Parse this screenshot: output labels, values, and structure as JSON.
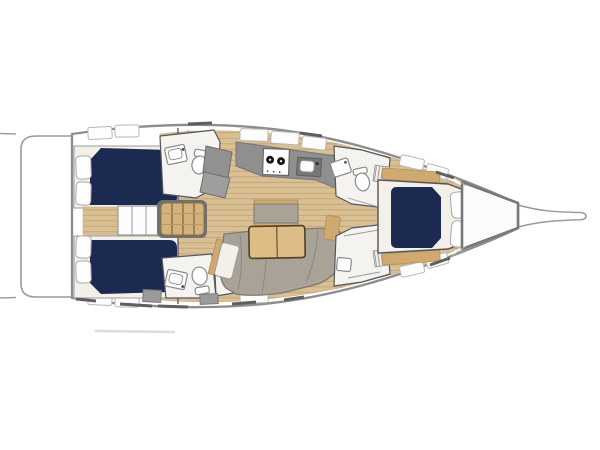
{
  "meta": {
    "type": "yacht-interior-floor-plan",
    "orientation": "bow-right",
    "background": "#ffffff"
  },
  "colors": {
    "hull_stroke": "#8e8e8e",
    "wall_stroke": "#55555e",
    "bed_navy": "#1c2950",
    "wood_floor": "#d9c094",
    "plank_line": "#c3a273",
    "wood_trim": "#cfa96f",
    "steps_wood": "#d4b27b",
    "table_wood": "#debc85",
    "table_edge": "#4f3e29",
    "sofa_gray": "#a9a296",
    "sofa_edge": "#7e7870",
    "counter_gray": "#8f8f8f",
    "shower_gray": "#919191",
    "room_floor": "#f5f3ef",
    "berth_cream": "#f2f0e9",
    "pillow_white": "#fdfdfd",
    "burner_black": "#1a1a1a"
  },
  "areas": [
    {
      "id": "swim-platform",
      "label": "Stern swim platform"
    },
    {
      "id": "aft-cabin-port",
      "label": "Aft double cabin (port)"
    },
    {
      "id": "aft-cabin-starboard",
      "label": "Aft double cabin (starboard)"
    },
    {
      "id": "companionway",
      "label": "Companionway steps"
    },
    {
      "id": "head-aft-port",
      "label": "Aft head with shower (port)"
    },
    {
      "id": "head-aft-starboard",
      "label": "Aft head with shower (starboard)"
    },
    {
      "id": "galley",
      "label": "Galley with two-burner stove and sink"
    },
    {
      "id": "salon",
      "label": "Salon with U-shaped sofa, folding table and bench"
    },
    {
      "id": "head-forward",
      "label": "Forward head"
    },
    {
      "id": "shower-forward",
      "label": "Forward shower room"
    },
    {
      "id": "cabin-forward",
      "label": "Forward cabin with island double berth"
    },
    {
      "id": "anchor-locker",
      "label": "Bow anchor locker"
    },
    {
      "id": "bowsprit",
      "label": "Bowsprit"
    }
  ]
}
